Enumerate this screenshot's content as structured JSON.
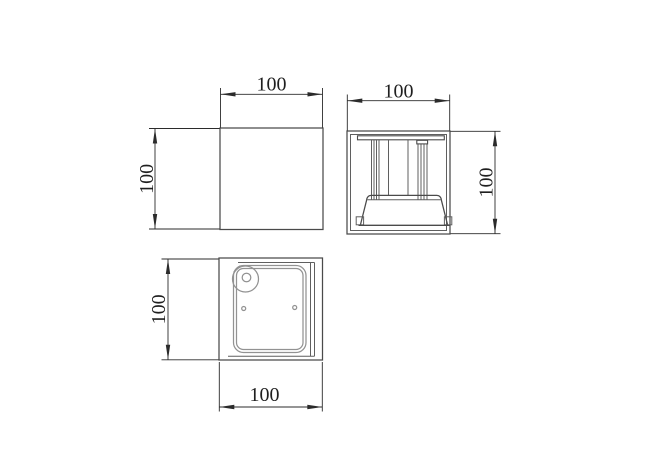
{
  "drawing": {
    "background": "#ffffff",
    "colors": {
      "object_line": "#4a4a4a",
      "mid_line": "#5f5f5f",
      "light_line": "#929292",
      "dim_line": "#2b2b2b",
      "text": "#1f1f1f"
    },
    "views": {
      "front": {
        "width_label": "100",
        "height_label": "100"
      },
      "side": {
        "width_label": "100",
        "height_label": "100"
      },
      "bottom": {
        "height_label": "100",
        "width_label": "100"
      }
    }
  }
}
